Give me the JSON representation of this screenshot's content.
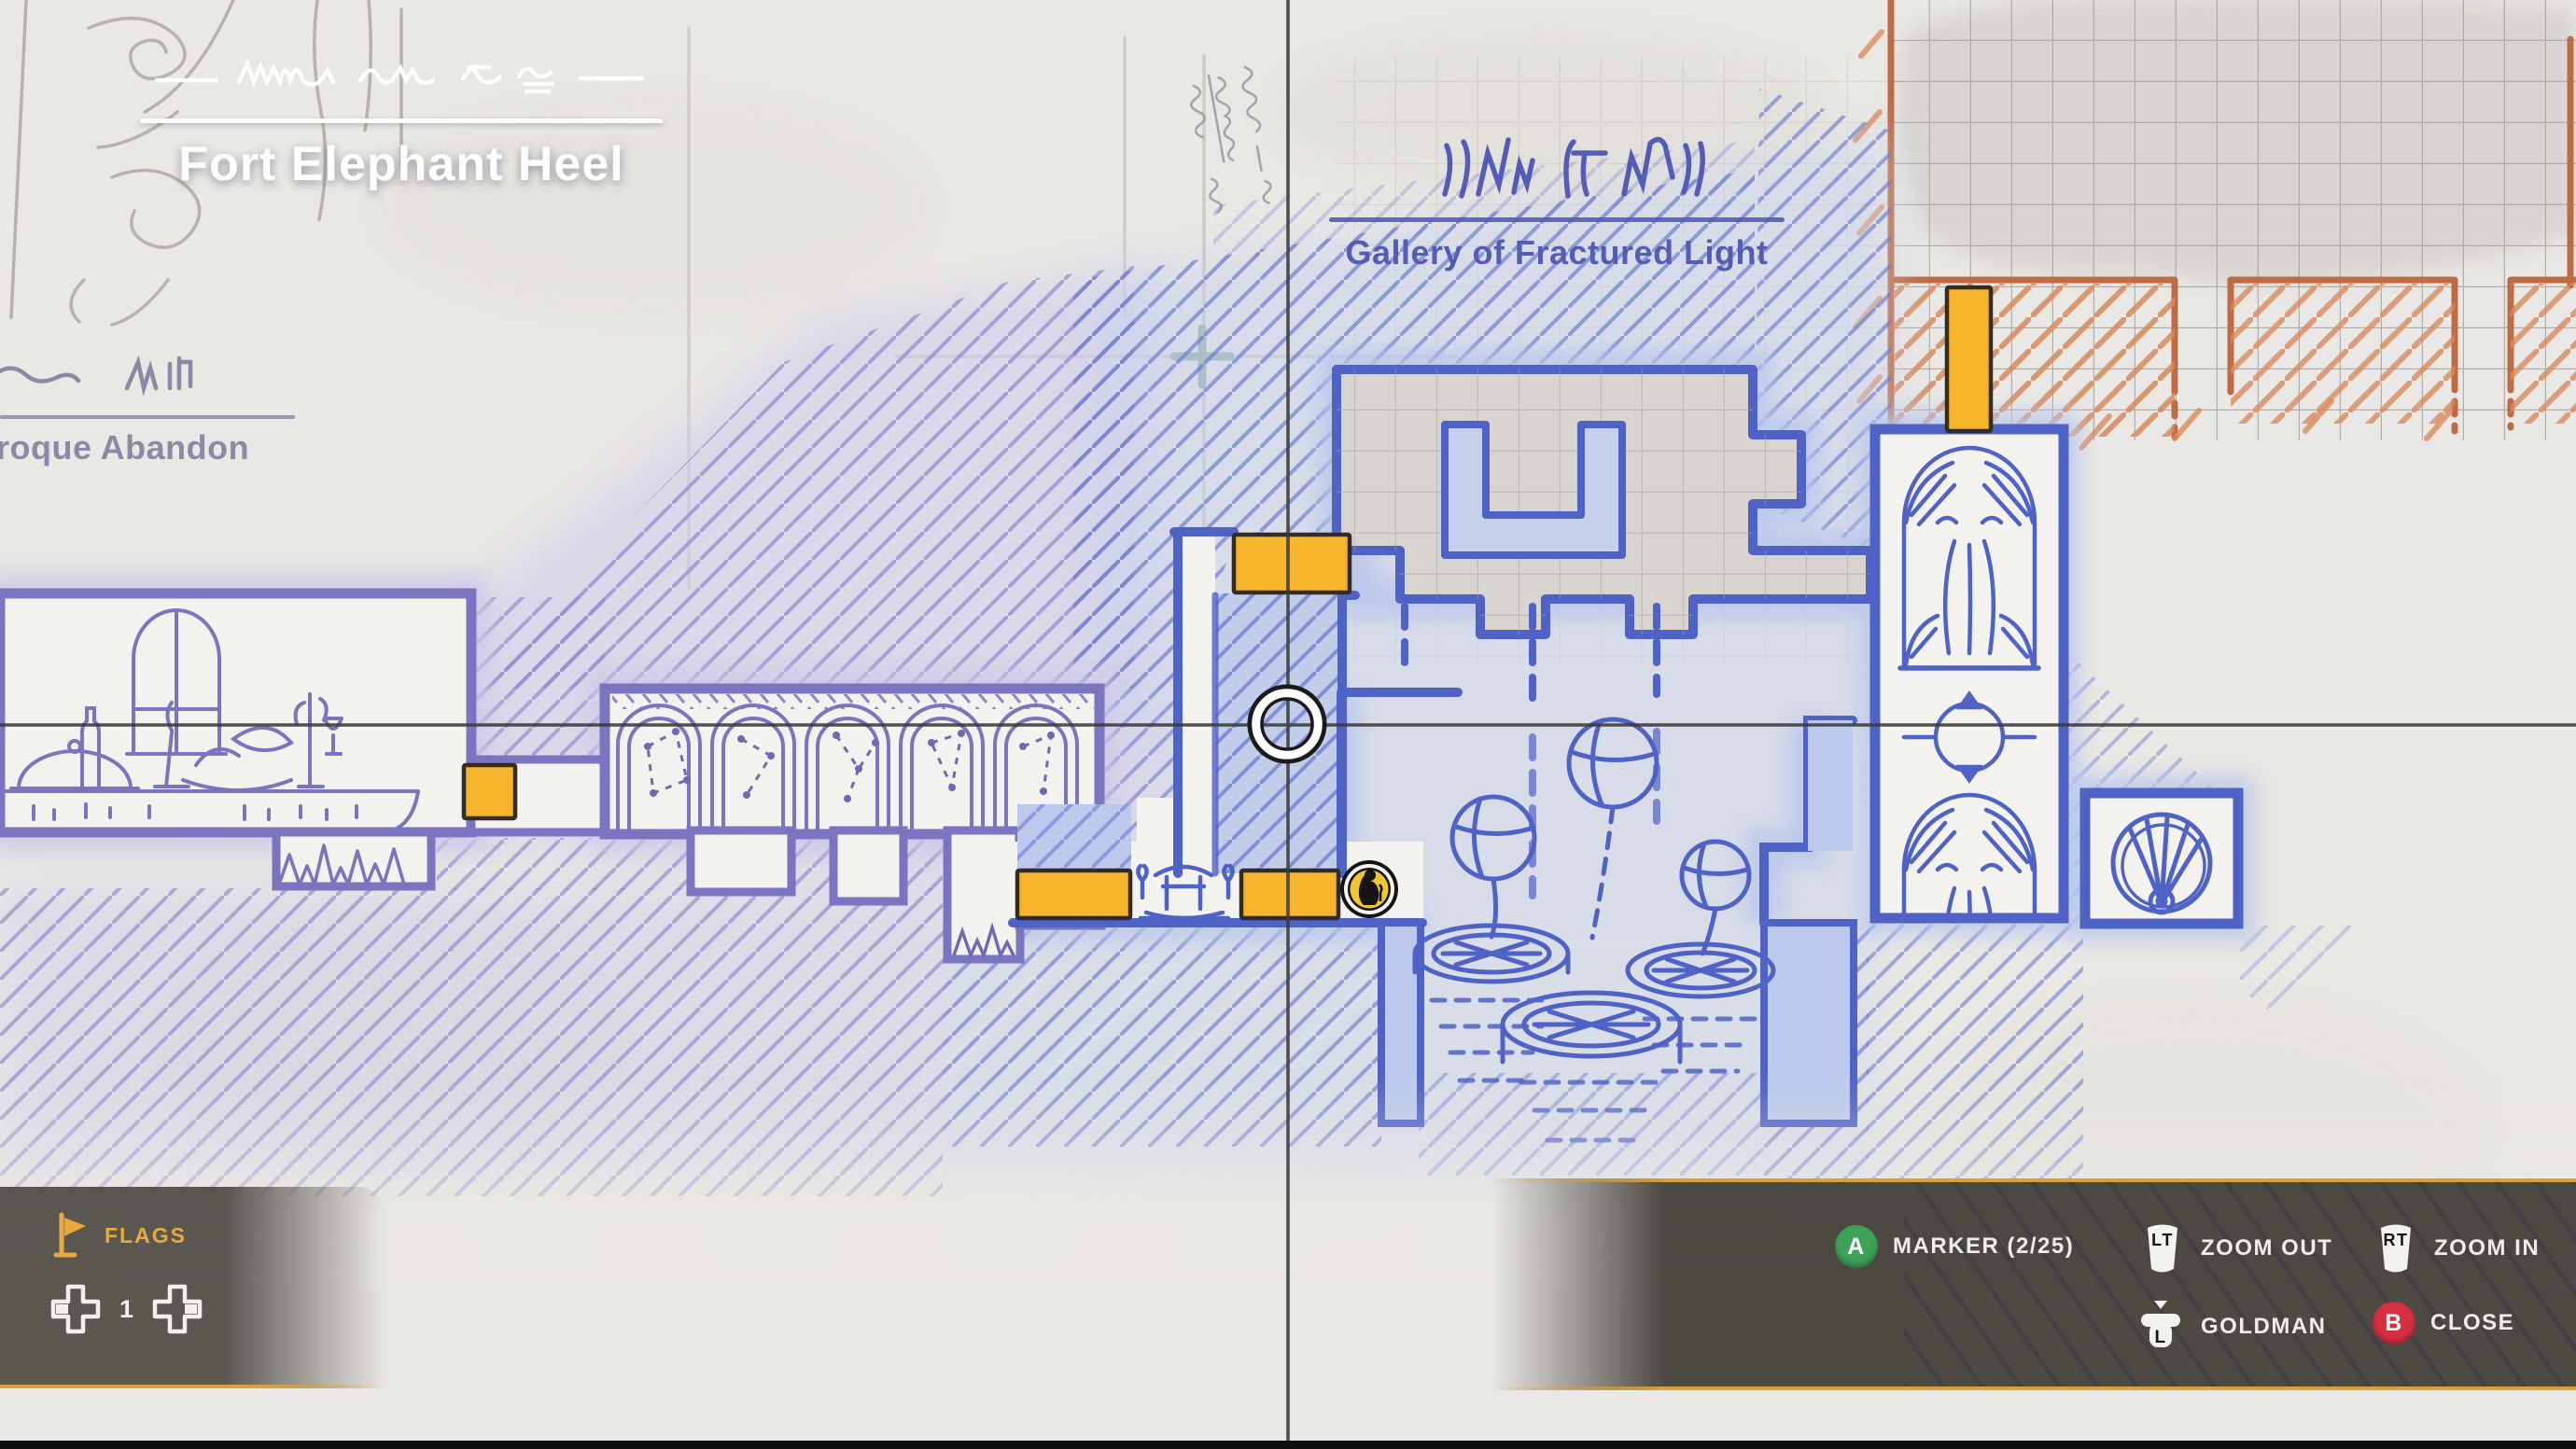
{
  "titles": {
    "region": "Fort Elephant Heel",
    "area_right": "Gallery of Fractured Light",
    "area_left": "roque Abandon"
  },
  "hud": {
    "flags": {
      "label": "FLAGS",
      "count": "1"
    },
    "actions": {
      "marker": {
        "button": "A",
        "label": "MARKER (2/25)"
      },
      "zoom_out": {
        "button": "LT",
        "label": "ZOOM OUT"
      },
      "zoom_in": {
        "button": "RT",
        "label": "ZOOM IN"
      },
      "goldman": {
        "button": "L",
        "label": "GOLDMAN"
      },
      "close": {
        "button": "B",
        "label": "CLOSE"
      }
    }
  },
  "icons": {
    "flag": "flag-icon",
    "dpad_left": "dpad-left-icon",
    "dpad_right": "dpad-right-icon",
    "a_button": "a-button-icon",
    "b_button": "b-button-icon",
    "lt_trigger": "lt-trigger-icon",
    "rt_trigger": "rt-trigger-icon",
    "l_stick": "l-stick-icon",
    "cursor": "map-cursor-ring",
    "player": "player-position-marker",
    "doors": "map-door-marker"
  },
  "colors": {
    "accent_yellow": "#f6b42c",
    "hud_gold": "#d9a23c",
    "blue_ink": "#4f62c5",
    "purple_ink": "#7b74c0",
    "orange_ink": "#bf6c45",
    "button_a_green": "#3ea257",
    "button_b_red": "#d62f42",
    "panel_gray": "#47433d",
    "label_blue": "#545cb5",
    "label_gray_purple": "#8e88a4",
    "title_white": "#fdfdfb"
  }
}
